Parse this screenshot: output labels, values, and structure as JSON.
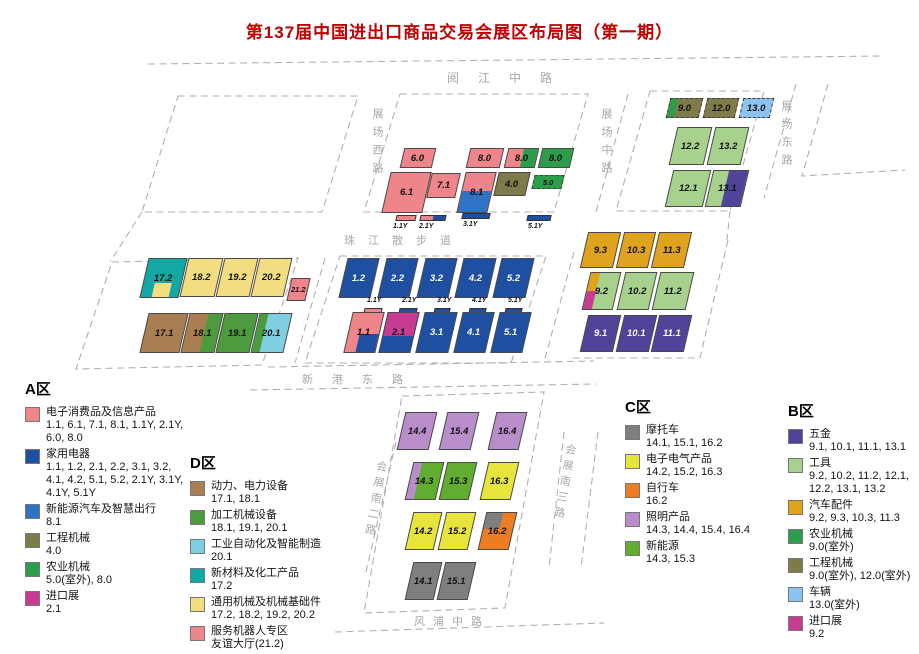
{
  "title": "第137届中国进出口商品交易会展区布局图（第一期）",
  "streets": {
    "yuejiang": "阅江中路",
    "zhanchang_xi": "展场西路",
    "zhanchang_zhong": "展场中路",
    "zhanchang_dong": "展场东路",
    "zhujiang": "珠江散步道",
    "xingang_dong": "新港东路",
    "huizhan_nan2": "会展南二路",
    "huizhan_nan3": "会展南三路",
    "fengpu": "风浦中路"
  },
  "halls": {
    "h60": "6.0",
    "h80a": "8.0",
    "h80b": "8.0",
    "h80c": "8.0",
    "h61": "6.1",
    "h71": "7.1",
    "h81": "8.1",
    "h40": "4.0",
    "h50": "5.0",
    "h90": "9.0",
    "h120": "12.0",
    "h130": "13.0",
    "h122": "12.2",
    "h132": "13.2",
    "h121": "12.1",
    "h131": "13.1",
    "h93": "9.3",
    "h103": "10.3",
    "h113": "11.3",
    "h92": "9.2",
    "h102": "10.2",
    "h112": "11.2",
    "h91": "9.1",
    "h101": "10.1",
    "h111": "11.1",
    "h172": "17.2",
    "h182": "18.2",
    "h192": "19.2",
    "h202": "20.2",
    "h212": "21.2",
    "h171": "17.1",
    "h181": "18.1",
    "h191": "19.1",
    "h201": "20.1",
    "h12": "1.2",
    "h22": "2.2",
    "h32": "3.2",
    "h42": "4.2",
    "h52": "5.2",
    "h11": "1.1",
    "h21": "2.1",
    "h31": "3.1",
    "h41": "4.1",
    "h51": "5.1",
    "h144": "14.4",
    "h154": "15.4",
    "h164": "16.4",
    "h143": "14.3",
    "h153": "15.3",
    "h163": "16.3",
    "h142": "14.2",
    "h152": "15.2",
    "h162": "16.2",
    "h141": "14.1",
    "h151": "15.1"
  },
  "y_labels": {
    "y11": "1.1Y",
    "y21": "2.1Y",
    "y31": "3.1Y",
    "y41": "4.1Y",
    "y51": "5.1Y"
  },
  "colors": {
    "electronics_pink": "#EE858B",
    "appliances_blue": "#1E4FA0",
    "nev_blue": "#2F74C4",
    "construction_olive": "#7E7A49",
    "agri_green": "#2C9E4B",
    "import_magenta": "#C73B92",
    "power_brown": "#A97E53",
    "processing_green": "#4C9B3E",
    "automation_lightblue": "#80CEE1",
    "materials_teal": "#13A8A4",
    "general_machinery_yellow": "#F2DD80",
    "motorcycle_gray": "#7F7F7F",
    "electrical_yellow": "#E7E53C",
    "bicycle_orange": "#ED7D23",
    "lighting_lilac": "#B98DCA",
    "new_energy_green": "#60AD30",
    "hardware_purple": "#4F4497",
    "tools_lightgreen": "#A9D18E",
    "autoparts_amber": "#DFA31D",
    "vehicles_lightblue": "#8CC3F1"
  },
  "legends": {
    "a": {
      "title": "A区",
      "items": [
        {
          "label": "电子消费品及信息产品",
          "codes": "1.1, 6.1, 7.1, 8.1, 1.1Y, 2.1Y, 6.0, 8.0",
          "color": "#EE858B"
        },
        {
          "label": "家用电器",
          "codes": "1.1, 1.2, 2.1, 2.2, 3.1, 3.2, 4.1, 4.2, 5.1, 5.2, 2.1Y, 3.1Y, 4.1Y, 5.1Y",
          "color": "#1E4FA0"
        },
        {
          "label": "新能源汽车及智慧出行",
          "codes": "8.1",
          "color": "#2F74C4"
        },
        {
          "label": "工程机械",
          "codes": "4.0",
          "color": "#7E7A49"
        },
        {
          "label": "农业机械",
          "codes": "5.0(室外), 8.0",
          "color": "#2C9E4B"
        },
        {
          "label": "进口展",
          "codes": "2.1",
          "color": "#C73B92"
        }
      ]
    },
    "d": {
      "title": "D区",
      "items": [
        {
          "label": "动力、电力设备",
          "codes": "17.1, 18.1",
          "color": "#A97E53"
        },
        {
          "label": "加工机械设备",
          "codes": "18.1, 19.1, 20.1",
          "color": "#4C9B3E"
        },
        {
          "label": "工业自动化及智能制造",
          "codes": "20.1",
          "color": "#80CEE1"
        },
        {
          "label": "新材料及化工产品",
          "codes": "17.2",
          "color": "#13A8A4"
        },
        {
          "label": "通用机械及机械基础件",
          "codes": "17.2, 18.2, 19.2, 20.2",
          "color": "#F2DD80"
        },
        {
          "label": "服务机器人专区",
          "codes": "友谊大厅(21.2)",
          "color": "#EE858B"
        }
      ]
    },
    "c": {
      "title": "C区",
      "items": [
        {
          "label": "摩托车",
          "codes": "14.1, 15.1, 16.2",
          "color": "#7F7F7F"
        },
        {
          "label": "电子电气产品",
          "codes": "14.2, 15.2, 16.3",
          "color": "#E7E53C"
        },
        {
          "label": "自行车",
          "codes": "16.2",
          "color": "#ED7D23"
        },
        {
          "label": "照明产品",
          "codes": "14.3, 14.4, 15.4, 16.4",
          "color": "#B98DCA"
        },
        {
          "label": "新能源",
          "codes": "14.3, 15.3",
          "color": "#60AD30"
        }
      ]
    },
    "b": {
      "title": "B区",
      "items": [
        {
          "label": "五金",
          "codes": "9.1, 10.1, 11.1, 13.1",
          "color": "#4F4497"
        },
        {
          "label": "工具",
          "codes": "9.2, 10.2, 11.2, 12.1, 12.2, 13.1, 13.2",
          "color": "#A9D18E"
        },
        {
          "label": "汽车配件",
          "codes": "9.2, 9.3, 10.3, 11.3",
          "color": "#DFA31D"
        },
        {
          "label": "农业机械",
          "codes": "9.0(室外)",
          "color": "#2C9E4B"
        },
        {
          "label": "工程机械",
          "codes": "9.0(室外), 12.0(室外)",
          "color": "#7E7A49"
        },
        {
          "label": "车辆",
          "codes": "13.0(室外)",
          "color": "#8CC3F1"
        },
        {
          "label": "进口展",
          "codes": "9.2",
          "color": "#C73B92"
        }
      ]
    }
  }
}
